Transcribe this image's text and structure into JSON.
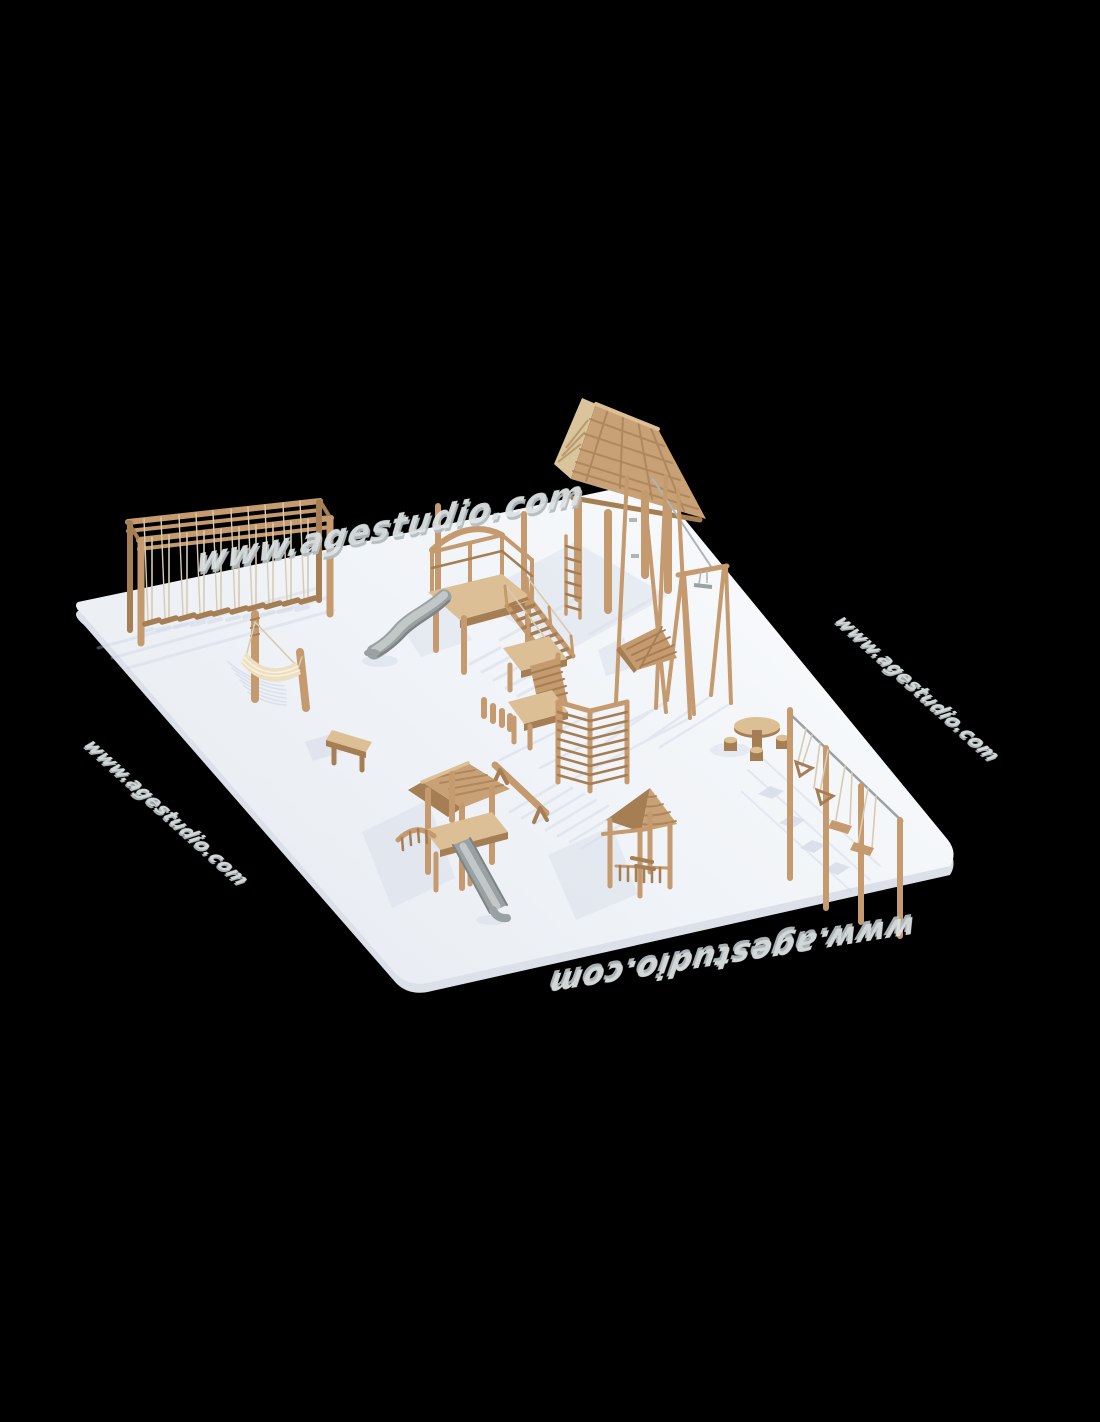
{
  "watermark": {
    "text": "www.agestudio.com"
  },
  "colors": {
    "background": "#000000",
    "platform": "#f3f5f8",
    "platform_edge": "#dce1e9",
    "wood": "#c49a6e",
    "wood_dark": "#a57e53",
    "wood_light": "#dcbf94",
    "roof": "#c9a176",
    "rope": "#d8cbb0",
    "slide": "#9aa1a2",
    "slide_light": "#c2c7c8",
    "slide_dark": "#7d8486",
    "canvas": "#ecdfc2",
    "shadow": "#c4cdde",
    "watermark": "#dde2e3",
    "watermark_shadow": "#b4bcbf"
  },
  "equipment": {
    "items": [
      "hanging-log-balance-frame",
      "hammock",
      "bench",
      "main-tower-with-slide",
      "stairs",
      "wobble-bridge",
      "low-deck",
      "stilt-house-tower",
      "zipline",
      "climbing-wedge",
      "monkey-bars",
      "balance-beam",
      "pavilion-with-slide",
      "gazebo-tower",
      "picnic-table",
      "hanging-traverse-course"
    ]
  }
}
